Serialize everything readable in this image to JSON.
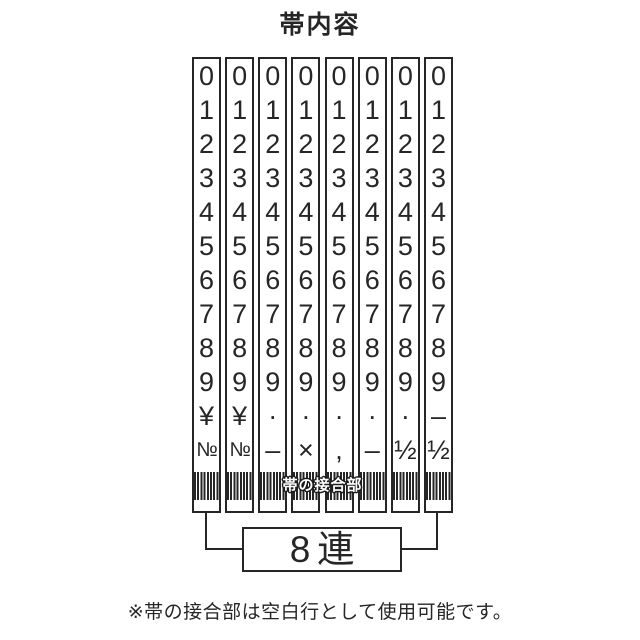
{
  "title": "帯内容",
  "band_table": {
    "joint_label": "帯の接合部",
    "columns": [
      {
        "cells": [
          "0",
          "1",
          "2",
          "3",
          "4",
          "5",
          "6",
          "7",
          "8",
          "9",
          "¥",
          "№"
        ]
      },
      {
        "cells": [
          "0",
          "1",
          "2",
          "3",
          "4",
          "5",
          "6",
          "7",
          "8",
          "9",
          "¥",
          "№"
        ]
      },
      {
        "cells": [
          "0",
          "1",
          "2",
          "3",
          "4",
          "5",
          "6",
          "7",
          "8",
          "9",
          "·",
          "–"
        ]
      },
      {
        "cells": [
          "0",
          "1",
          "2",
          "3",
          "4",
          "5",
          "6",
          "7",
          "8",
          "9",
          "·",
          "×"
        ]
      },
      {
        "cells": [
          "0",
          "1",
          "2",
          "3",
          "4",
          "5",
          "6",
          "7",
          "8",
          "9",
          "·",
          ","
        ]
      },
      {
        "cells": [
          "0",
          "1",
          "2",
          "3",
          "4",
          "5",
          "6",
          "7",
          "8",
          "9",
          "·",
          "–"
        ]
      },
      {
        "cells": [
          "0",
          "1",
          "2",
          "3",
          "4",
          "5",
          "6",
          "7",
          "8",
          "9",
          "·",
          "½"
        ]
      },
      {
        "cells": [
          "0",
          "1",
          "2",
          "3",
          "4",
          "5",
          "6",
          "7",
          "8",
          "9",
          "–",
          "½"
        ]
      }
    ]
  },
  "count_label": "8連",
  "note": "※帯の接合部は空白行として使用可能です。",
  "colors": {
    "ink": "#262626",
    "background": "#ffffff"
  }
}
